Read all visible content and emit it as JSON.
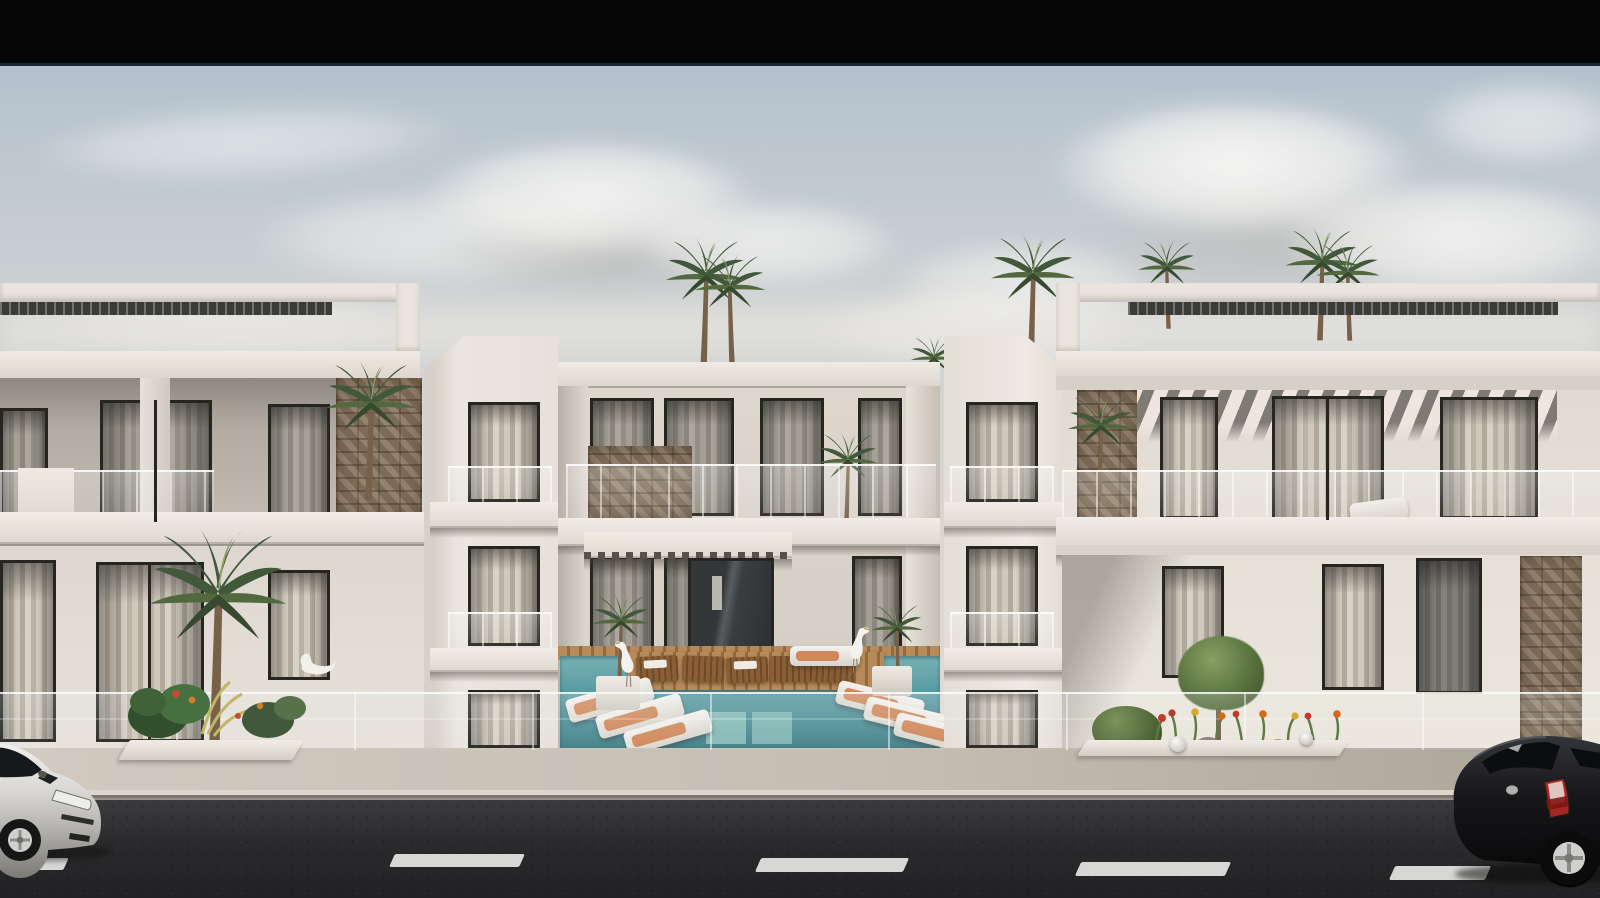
{
  "meta": {
    "width": 1600,
    "height": 898,
    "kind": "3D architectural exterior rendering",
    "no_visible_text": true
  },
  "scene": {
    "description": "Street-level rendering of a modern three-storey white residential complex: two symmetrical wings with rooftop pergolas flank a recessed central block with a swimming-pool courtyard, wooden deck and sun loungers, rooftop palm trees, a glass balustrade, sidewalk planters with tropical plants and flowers, and an asphalt road with dashed lane markings, a silver car at the left edge and a black car at the right edge, under a soft cloudy sky with a black letterbox bar across the top.",
    "objects": {
      "letterbox": {
        "label": "black letterbox bar"
      },
      "sky": {
        "label": "hazy sky with soft clouds"
      },
      "left_wing": {
        "label": "left building wing with recessed balcony gallery"
      },
      "right_wing": {
        "label": "right building wing with striped awning"
      },
      "central_block": {
        "label": "central building with entrance canopy"
      },
      "left_tower": {
        "label": "left tower with stacked balconies"
      },
      "right_tower": {
        "label": "right tower with stacked balconies"
      },
      "pergola_left": {
        "label": "rooftop pergola with louvers, left wing"
      },
      "pergola_right": {
        "label": "rooftop pergola with louvers, right wing"
      },
      "awning": {
        "label": "striped awning shadow band"
      },
      "pool": {
        "label": "courtyard swimming pool"
      },
      "pool_deck": {
        "label": "wooden pool deck island with loungers"
      },
      "glass_fence": {
        "label": "glass balustrade along the terrace front"
      },
      "planter_left": {
        "label": "sidewalk planter with monstera and palm"
      },
      "flower_bed": {
        "label": "flower bed with shrub and sphere lamps"
      },
      "palm_trees": {
        "label": "rooftop palm trees"
      },
      "egrets": {
        "label": "white egret sculptures by the pool"
      },
      "sidewalk": {
        "label": "light paved sidewalk and curb"
      },
      "road": {
        "label": "asphalt road with dashed lane markings"
      },
      "white_car": {
        "label": "silver hatchback car, left"
      },
      "black_car": {
        "label": "black hatchback car, right"
      }
    },
    "palette": {
      "letterbox": "#060606",
      "sky_top": "#b4c2ce",
      "sky_mid": "#cdd1d3",
      "sky_low": "#dcd8d1",
      "cloud": "#f0eee9",
      "wall_bright": "#eae5de",
      "wall_mid": "#ddd7cf",
      "wall_shade": "#b3aca3",
      "recess": "#938d85",
      "stone": "#87745e",
      "frame": "#26251f",
      "curtain_a": "#d8d1c5",
      "curtain_b": "#b9b1a4",
      "awning_light": "#efe9e1",
      "awning_dark": "#6e6a64",
      "pool_light": "#7ab3b4",
      "pool_dark": "#417f89",
      "wood": "#ab7c4c",
      "lounger_orange": "#cd7d4a",
      "leaf_dark": "#37492f",
      "leaf_mid": "#4c6340",
      "leaf_light": "#6d8a5a",
      "sidewalk": "#c7c1b6",
      "curb": "#7a756d",
      "road": "#2b2b2d",
      "lane": "#e5e6e3",
      "car_silver": "#d6d5d1",
      "car_black": "#121214",
      "taillight": "#c03a30"
    }
  }
}
